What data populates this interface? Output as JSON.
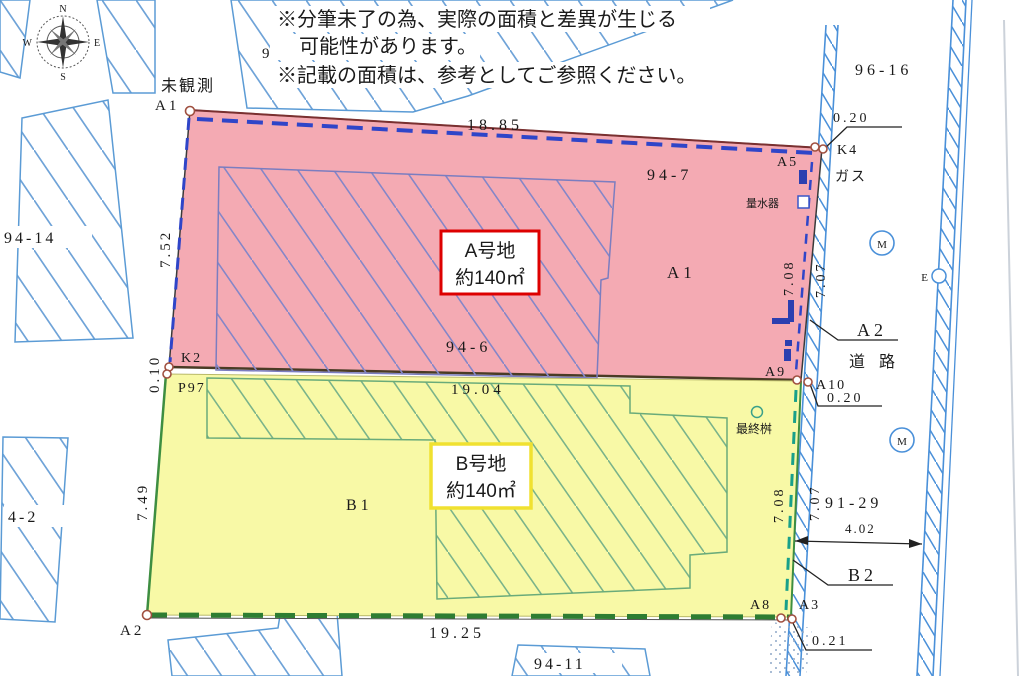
{
  "notes": {
    "line1": "※分筆未了の為、実際の面積と差異が生じる",
    "line2": "可能性があります。",
    "line3": "※記載の面積は、参考としてご参照ください。",
    "stray_digit": "9"
  },
  "compass": {
    "n": "N",
    "e": "E",
    "s": "S",
    "w": "W"
  },
  "survey": {
    "unobserved_label": "未観測"
  },
  "parcel_a": {
    "box_title": "A号地",
    "box_area": "約140㎡",
    "house_label": "A1",
    "lot_number_road": "94-7",
    "lot_number_main": "94-6",
    "dim_top": "18.85",
    "dim_left": "7.52",
    "dim_left_offset": "0.10",
    "dim_right_inner": "7.08",
    "dim_right_outer": "7.07",
    "offset_top_right": "0.20",
    "pt_a1": "A1",
    "pt_a5": "A5",
    "pt_k4": "K4",
    "pt_k2": "K2",
    "pt_a9": "A9",
    "gas_label": "ガス",
    "water_meter_label": "量水器",
    "fill": "#f4aab3",
    "box_border": "#dd0000"
  },
  "parcel_b": {
    "box_title": "B号地",
    "box_area": "約140㎡",
    "house_label": "B1",
    "dim_top": "19.04",
    "dim_left": "7.49",
    "dim_bottom": "19.25",
    "dim_right_inner": "7.08",
    "dim_right_outer": "7.07",
    "offset_right": "0.20",
    "offset_bottom": "0.21",
    "pt_p97": "P97",
    "pt_a10": "A10",
    "pt_a2": "A2",
    "pt_a8": "A8",
    "pt_a3": "A3",
    "final_basin_label": "最終桝",
    "fill": "#f8f9a6",
    "box_border": "#f0e130"
  },
  "road": {
    "label": "道路",
    "pt_a2": "A2",
    "pt_b2": "B2",
    "width_dim": "4.02",
    "manhole_label": "M",
    "marker_e": "E"
  },
  "surrounding_lots": {
    "northwest": "94-14",
    "southwest": "4-2",
    "northeast": "96-16",
    "east": "91-29",
    "south": "94-11"
  }
}
